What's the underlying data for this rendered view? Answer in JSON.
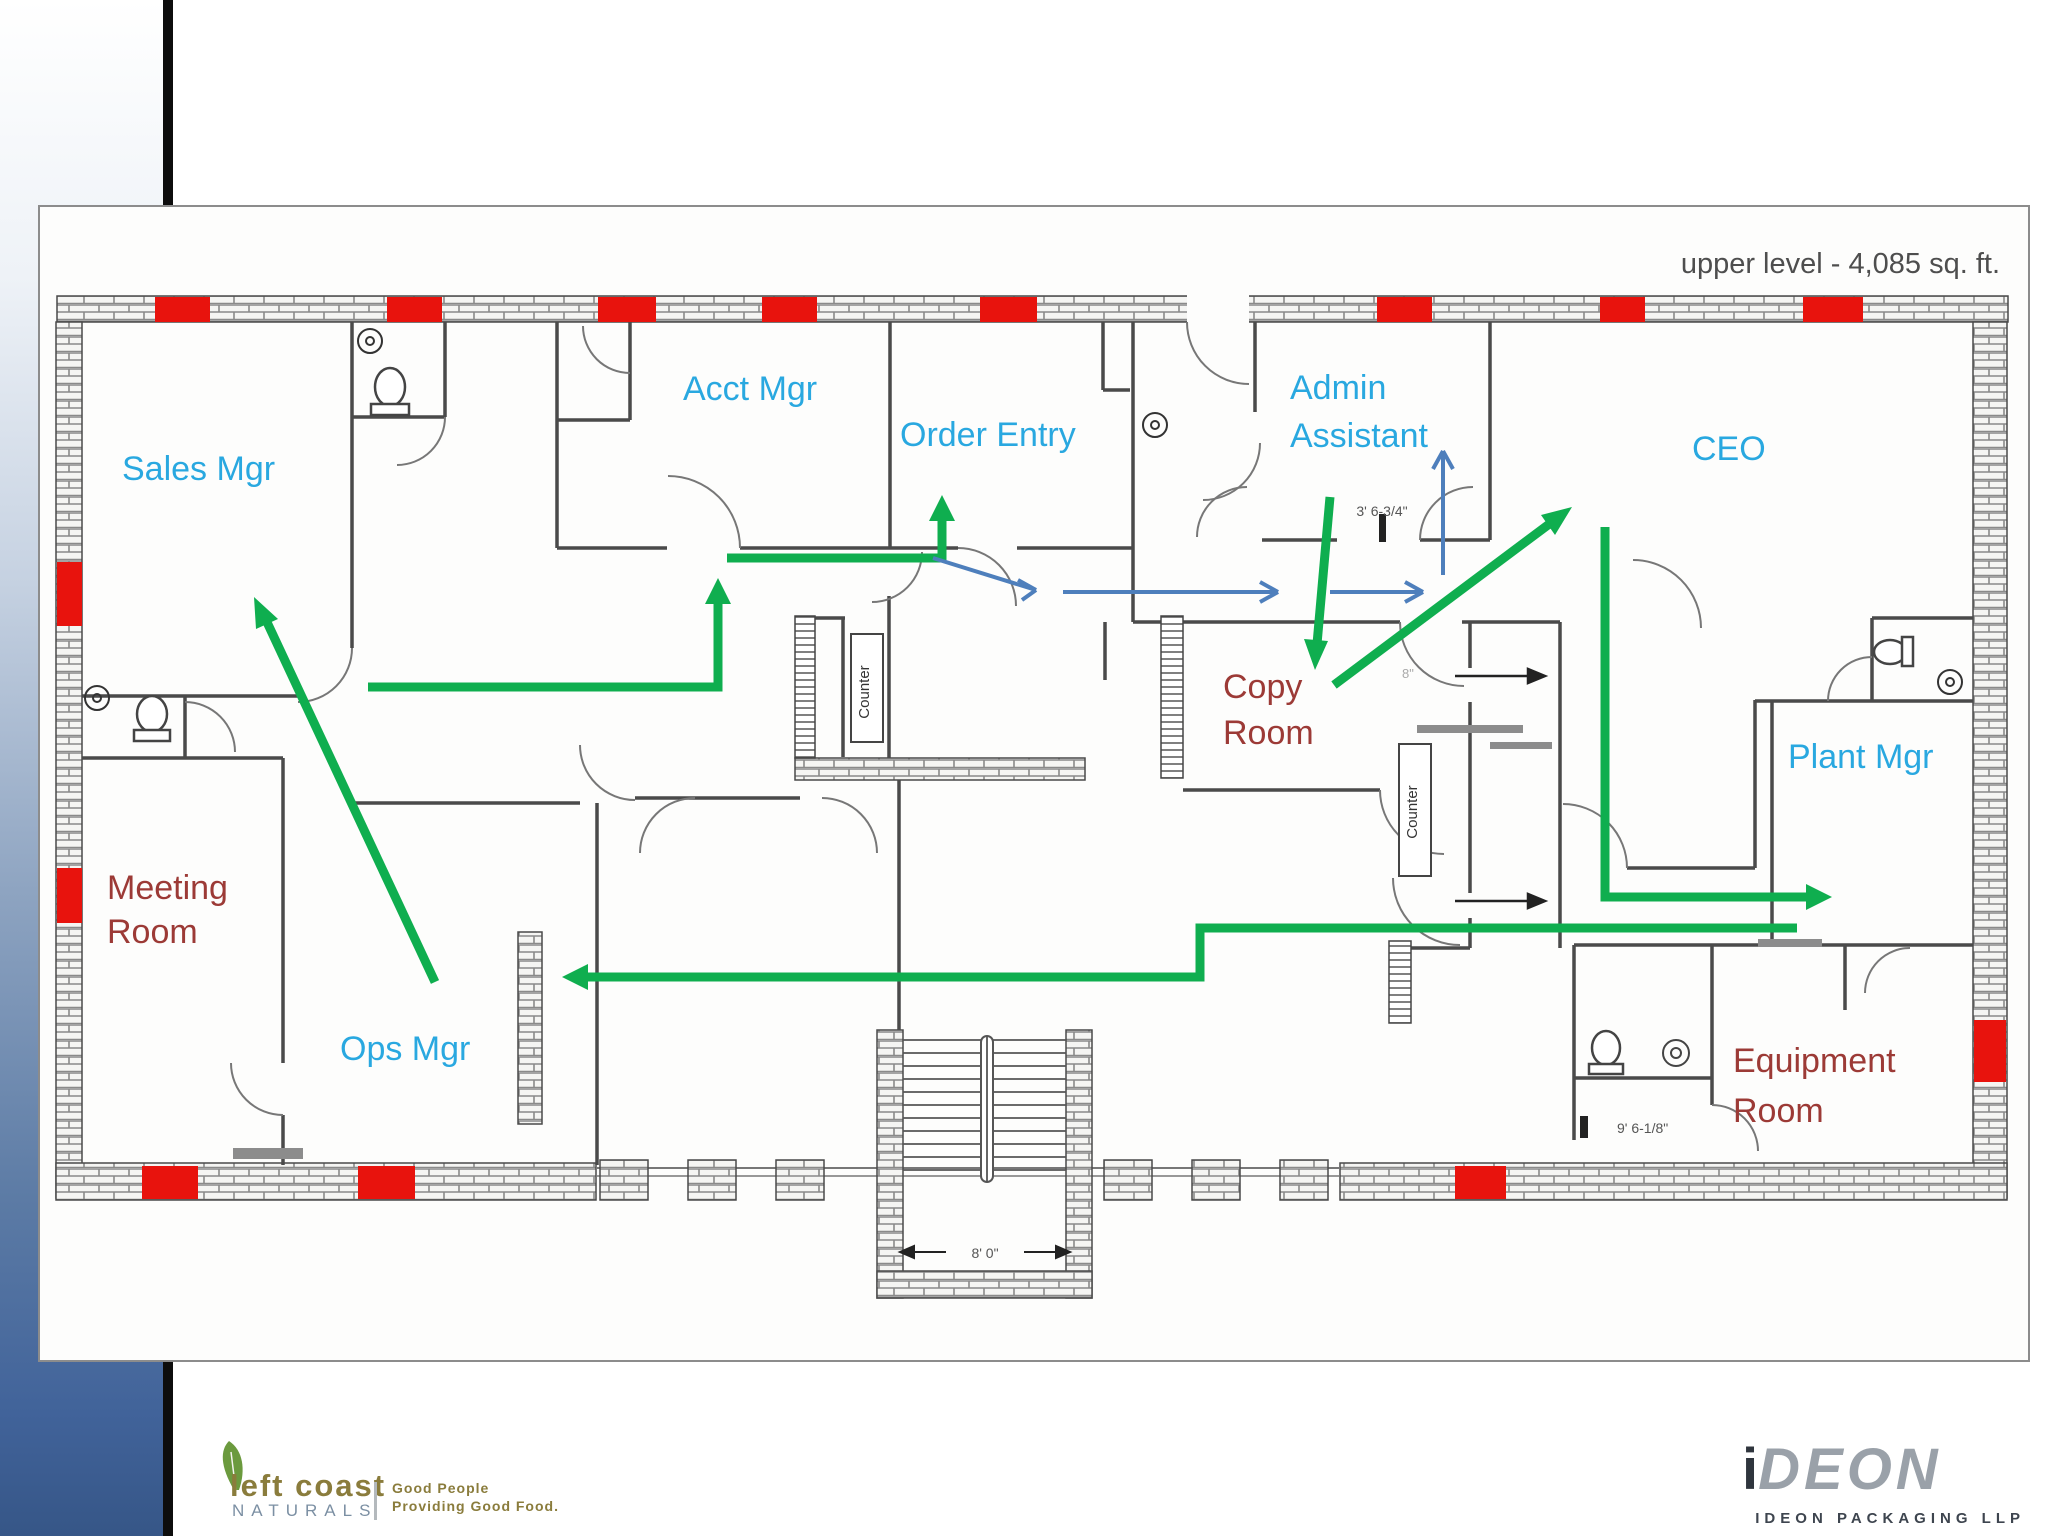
{
  "slide": {
    "title": "upper level - 4,085 sq. ft."
  },
  "rooms": {
    "sales": "Sales Mgr",
    "acct": "Acct Mgr",
    "order": "Order Entry",
    "admin1": "Admin",
    "admin2": "Assistant",
    "ceo": "CEO",
    "plant": "Plant Mgr",
    "ops": "Ops Mgr",
    "meeting1": "Meeting",
    "meeting2": "Room",
    "copy1": "Copy",
    "copy2": "Room",
    "equipment1": "Equipment",
    "equipment2": "Room"
  },
  "fixtures": {
    "counter_left": "Counter",
    "counter_right": "Counter"
  },
  "dimensions": {
    "admin_door": "3' 6-3/4\"",
    "washroom": "9' 6-1/8\"",
    "stair_width": "8' 0\"",
    "copy_door": "8\""
  },
  "footer": {
    "left_coast": {
      "name_line1": "left coast",
      "name_line2": "NATURALS",
      "tagline_line1": "Good People",
      "tagline_line2": "Providing Good Food."
    },
    "ideon": {
      "mark_i": "i",
      "mark_rest": "DEON",
      "subtitle": "IDEON PACKAGING LLP"
    }
  },
  "colors": {
    "room_label_blue": "#29a8e0",
    "room_label_red": "#9c3a36",
    "arrow_green": "#0fae4f",
    "arrow_blue": "#4e7fbc",
    "window_red": "#e8130d",
    "wall_gray": "#4a4a4a"
  }
}
